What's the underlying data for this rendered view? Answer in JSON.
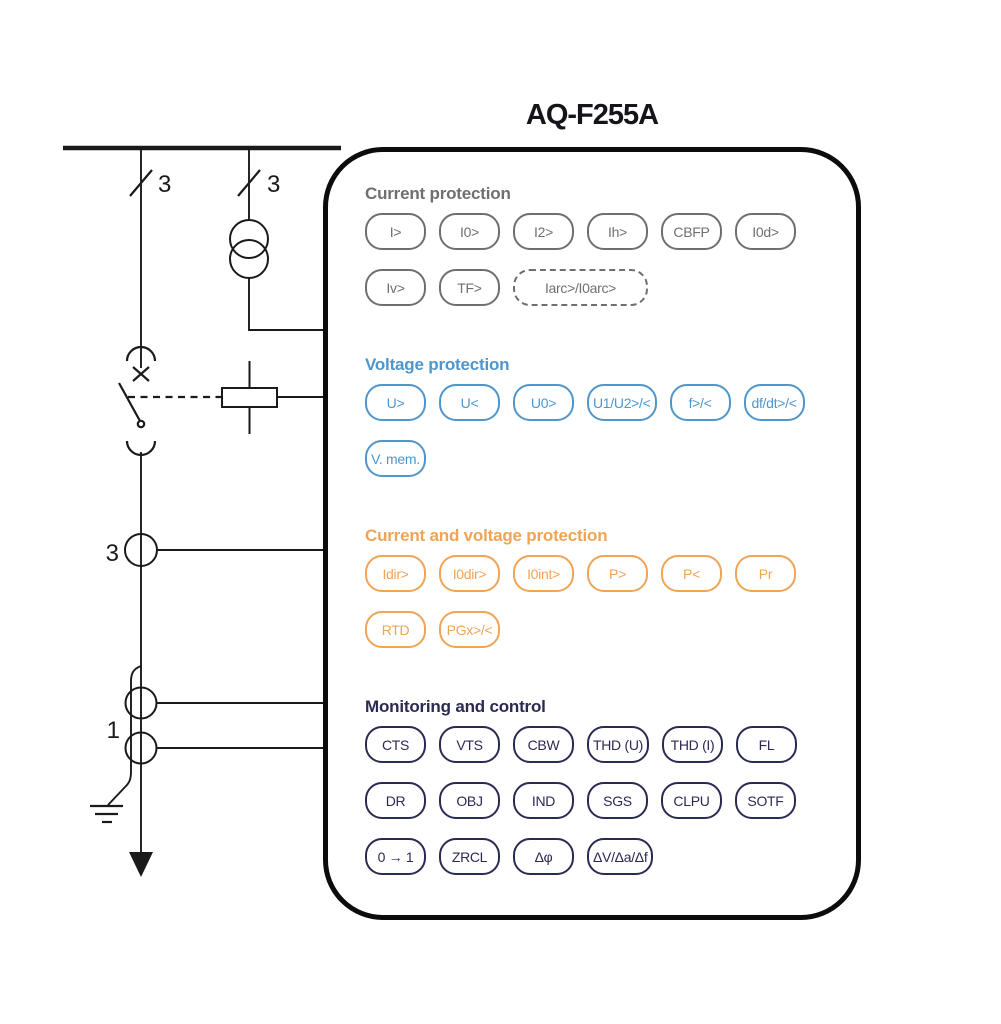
{
  "title": "AQ-F255A",
  "diagram": {
    "labels": {
      "incoming_phases_left": "3",
      "incoming_phases_right": "3",
      "phase_ct": "3",
      "ring_ct": "1"
    }
  },
  "relay": {
    "sections": [
      {
        "label": "Current protection",
        "color": "#6f6f6f",
        "rows": [
          [
            {
              "label": "I>"
            },
            {
              "label": "I0>"
            },
            {
              "label": "I2>"
            },
            {
              "label": "Ih>"
            },
            {
              "label": "CBFP"
            },
            {
              "label": "I0d>"
            }
          ],
          [
            {
              "label": "Iv>"
            },
            {
              "label": "TF>"
            },
            {
              "label": "Iarc>/I0arc>",
              "wide": true,
              "dashed": true
            }
          ]
        ]
      },
      {
        "label": "Voltage protection",
        "color": "#4e96cb",
        "rows": [
          [
            {
              "label": "U>"
            },
            {
              "label": "U<"
            },
            {
              "label": "U0>"
            },
            {
              "label": "U1/U2>/<"
            },
            {
              "label": "f>/<"
            },
            {
              "label": "df/dt>/<"
            }
          ],
          [
            {
              "label": "V. mem."
            }
          ]
        ]
      },
      {
        "label": "Current and voltage protection",
        "color": "#f0a455",
        "rows": [
          [
            {
              "label": "Idir>"
            },
            {
              "label": "I0dir>"
            },
            {
              "label": "I0int>"
            },
            {
              "label": "P>"
            },
            {
              "label": "P<"
            },
            {
              "label": "Pr"
            }
          ],
          [
            {
              "label": "RTD"
            },
            {
              "label": "PGx>/<"
            }
          ]
        ]
      },
      {
        "label": "Monitoring and control",
        "color": "#2b2a52",
        "rows": [
          [
            {
              "label": "CTS"
            },
            {
              "label": "VTS"
            },
            {
              "label": "CBW"
            },
            {
              "label": "THD (U)"
            },
            {
              "label": "THD (I)"
            },
            {
              "label": "FL"
            }
          ],
          [
            {
              "label": "DR"
            },
            {
              "label": "OBJ"
            },
            {
              "label": "IND"
            },
            {
              "label": "SGS"
            },
            {
              "label": "CLPU"
            },
            {
              "label": "SOTF"
            }
          ],
          [
            {
              "label": "0 → 1"
            },
            {
              "label": "ZRCL"
            },
            {
              "label": "Δφ"
            },
            {
              "label": "ΔV/Δa/Δf"
            }
          ]
        ]
      }
    ]
  }
}
